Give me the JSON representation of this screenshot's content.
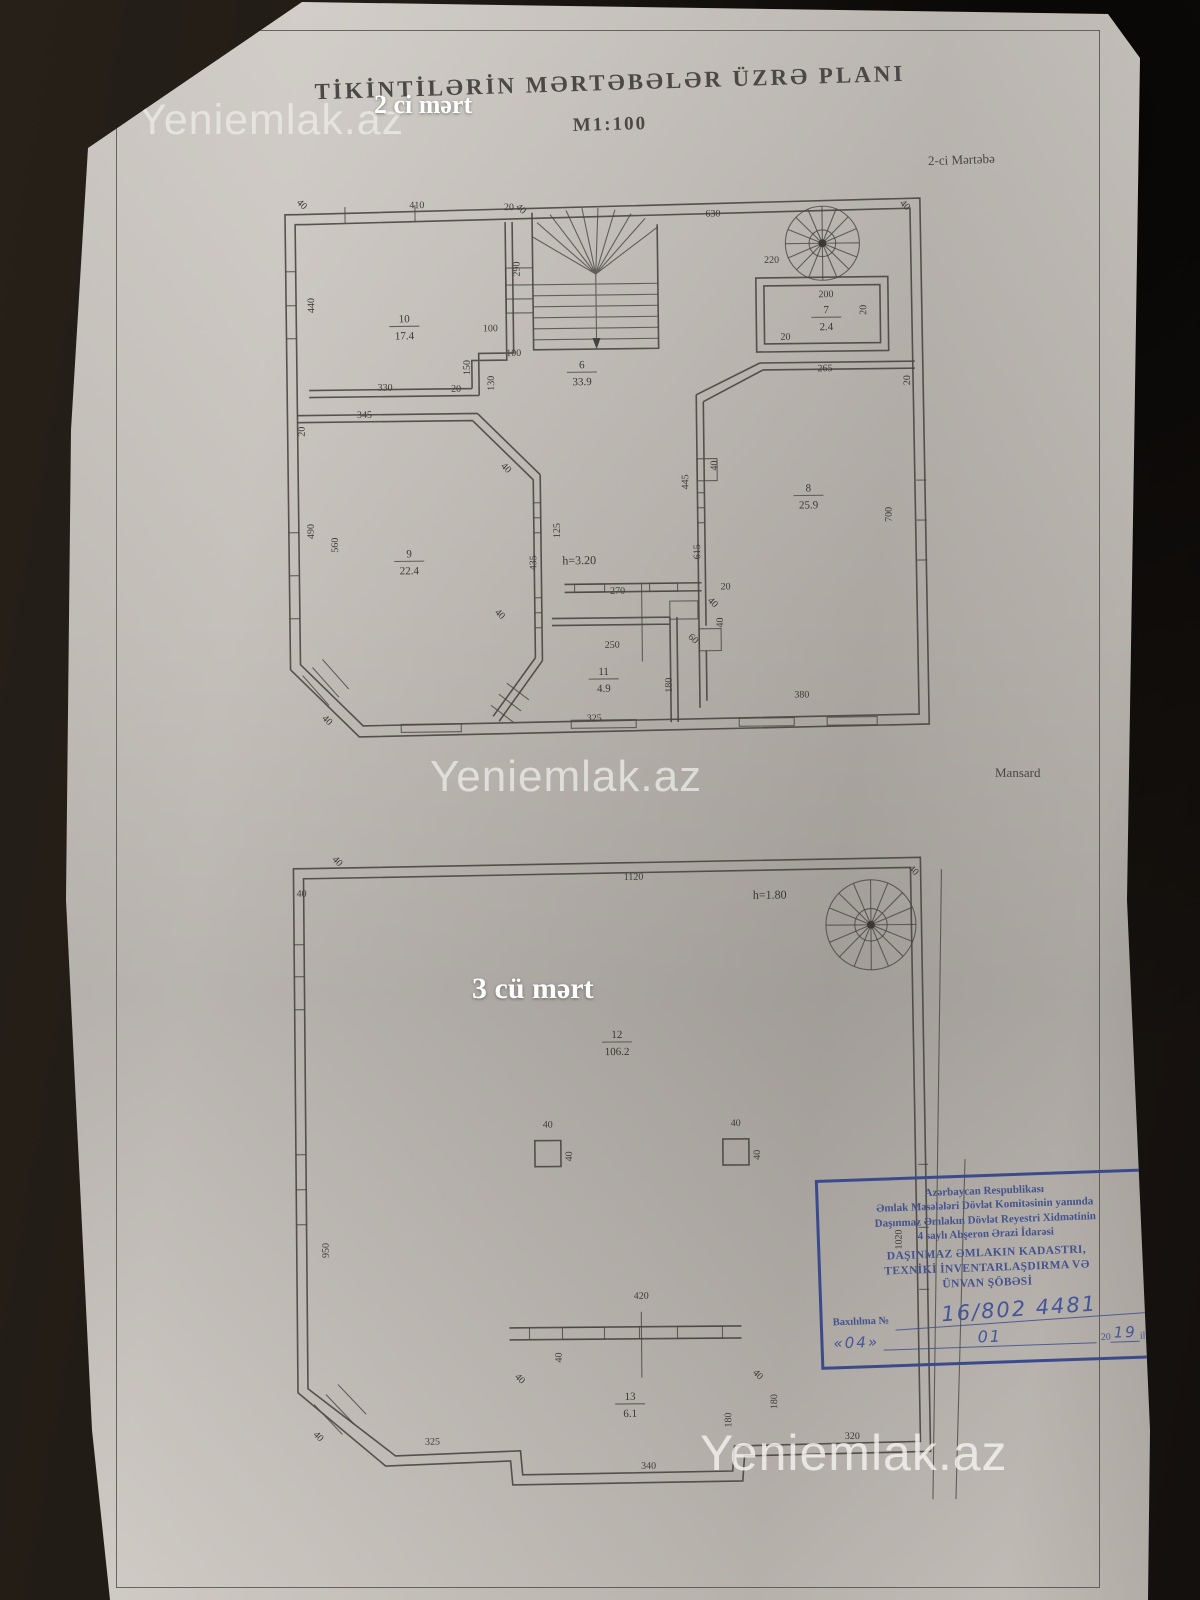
{
  "header": {
    "title": "TİKİNTİLƏRİN MƏRTƏBƏLƏR ÜZRƏ PLANI",
    "scale": "M1:100"
  },
  "watermarks": {
    "top": "Yeniemlak.az",
    "middle": "Yeniemlak.az",
    "bottom": "Yeniemlak.az"
  },
  "overlays": {
    "floor2": "2 ci mərt",
    "floor3": "3 cü mərt"
  },
  "plan2": {
    "caption": "2-ci Mərtəbə",
    "height_note": "h=3.20",
    "height_xy": [
      310,
      392
    ],
    "rooms": [
      {
        "num": "10",
        "area": "17.4",
        "x": 138,
        "y": 148
      },
      {
        "num": "6",
        "area": "33.9",
        "x": 315,
        "y": 196
      },
      {
        "num": "7",
        "area": "2.4",
        "x": 560,
        "y": 144
      },
      {
        "num": "9",
        "area": "22.4",
        "x": 140,
        "y": 383
      },
      {
        "num": "8",
        "area": "25.9",
        "x": 540,
        "y": 322
      },
      {
        "num": "11",
        "area": "4.9",
        "x": 333,
        "y": 503
      }
    ],
    "dims": [
      [
        "410",
        152,
        34,
        0
      ],
      [
        "20",
        244,
        37,
        0
      ],
      [
        "440",
        48,
        130,
        -90
      ],
      [
        "630",
        448,
        46,
        0
      ],
      [
        "290",
        254,
        96,
        -90
      ],
      [
        "220",
        506,
        93,
        0
      ],
      [
        "200",
        560,
        128,
        0
      ],
      [
        "20",
        600,
        141,
        -90
      ],
      [
        "20",
        519,
        170,
        0
      ],
      [
        "265",
        558,
        202,
        0
      ],
      [
        "20",
        643,
        212,
        -90
      ],
      [
        "100",
        224,
        158,
        0
      ],
      [
        "100",
        247,
        183,
        0
      ],
      [
        "150",
        203,
        194,
        -90
      ],
      [
        "130",
        227,
        210,
        -90
      ],
      [
        "330",
        118,
        216,
        0
      ],
      [
        "20",
        189,
        218,
        0
      ],
      [
        "345",
        97,
        243,
        0
      ],
      [
        "20",
        37,
        256,
        -90
      ],
      [
        "490",
        45,
        356,
        -90
      ],
      [
        "560",
        69,
        370,
        -90
      ],
      [
        "125",
        291,
        358,
        -90
      ],
      [
        "435",
        267,
        390,
        -90
      ],
      [
        "40",
        449,
        295,
        -90
      ],
      [
        "445",
        420,
        311,
        -90
      ],
      [
        "615",
        431,
        381,
        -90
      ],
      [
        "700",
        623,
        346,
        -90
      ],
      [
        "270",
        348,
        422,
        0
      ],
      [
        "250",
        342,
        476,
        0
      ],
      [
        "180",
        401,
        514,
        -90
      ],
      [
        "325",
        323,
        549,
        0
      ],
      [
        "380",
        531,
        528,
        0
      ],
      [
        "40",
        441,
        434,
        45
      ],
      [
        "20",
        456,
        419,
        0
      ],
      [
        "40",
        453,
        452,
        -90
      ],
      [
        "60",
        421,
        470,
        45
      ],
      [
        "40",
        35,
        31,
        45
      ],
      [
        "40",
        54,
        547,
        45
      ],
      [
        "40",
        638,
        39,
        45
      ],
      [
        "40",
        254,
        38,
        45
      ],
      [
        "40",
        236,
        297,
        45
      ],
      [
        "40",
        228,
        443,
        45
      ]
    ]
  },
  "plan3": {
    "caption": "Mansard",
    "height_note": "h=1.80",
    "height_xy": [
      504,
      78
    ],
    "rooms": [
      {
        "num": "12",
        "area": "106.2",
        "x": 350,
        "y": 216
      },
      {
        "num": "13",
        "area": "6.1",
        "x": 360,
        "y": 578
      }
    ],
    "dims": [
      [
        "1120",
        368,
        58,
        0
      ],
      [
        "40",
        70,
        39,
        45
      ],
      [
        "40",
        36,
        72,
        0
      ],
      [
        "40",
        646,
        53,
        45
      ],
      [
        "950",
        60,
        426,
        -90
      ],
      [
        "1020",
        633,
        420,
        -90
      ],
      [
        "40",
        280,
        305,
        0
      ],
      [
        "40",
        304,
        334,
        -90
      ],
      [
        "40",
        468,
        305,
        0
      ],
      [
        "40",
        492,
        334,
        -90
      ],
      [
        "420",
        372,
        477,
        0
      ],
      [
        "40",
        248,
        558,
        45
      ],
      [
        "40",
        486,
        556,
        45
      ],
      [
        "40",
        292,
        535,
        -90
      ],
      [
        "180",
        461,
        599,
        -90
      ],
      [
        "180",
        507,
        581,
        -90
      ],
      [
        "325",
        162,
        621,
        0
      ],
      [
        "340",
        378,
        647,
        0
      ],
      [
        "320",
        582,
        619,
        0
      ],
      [
        "40",
        46,
        614,
        45
      ]
    ]
  },
  "stamp": {
    "org_lines": [
      "Azərbaycan Respublikası",
      "Əmlak Məsələləri Dövlət Komitəsinin yanında",
      "Daşınmaz Əmlakın Dövlət Reyestri Xidmətinin",
      "4 saylı Abşeron Ərazi İdarəsi"
    ],
    "dept_lines": [
      "DAŞINMAZ ƏMLAKIN KADASTRI,",
      "TEXNİKİ İNVENTARLAŞDIRMA VƏ",
      "ÜNVAN ŞÖBƏSİ"
    ],
    "number_label": "Baxılılma №",
    "number_value": "16/802 4481",
    "day": "«04»",
    "month": "01",
    "year_prefix": "20",
    "year_value": "19",
    "year_suffix": "il",
    "border_color": "#3b4a8c"
  }
}
